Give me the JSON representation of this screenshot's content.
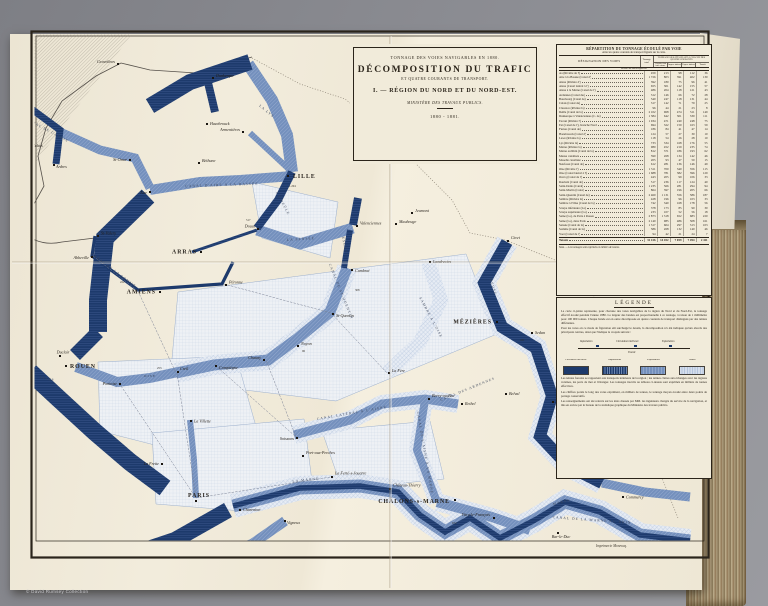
{
  "caption": "© David Rumsey Collection",
  "colors": {
    "band_dark": "#1d3a6c",
    "band_medium": "#7490bd",
    "band_light": "#dbe4ef",
    "sheet": "#f0ead9"
  },
  "plate": {
    "credit": "Imprimerie Monrocq.",
    "title_block": {
      "line1": "TONNAGE DES VOIES NAVIGABLES EN 1880.",
      "line2": "DÉCOMPOSITION DU TRAFIC",
      "line3": "ET QUATRE COURANTS DE TRANSPORT.",
      "line4": "I. — RÉGION DU NORD ET DU NORD-EST.",
      "line5": "MINISTÈRE DES TRAVAUX PUBLICS.",
      "line6": "1880 - 1881."
    },
    "table": {
      "title": "RÉPARTITION DU TONNAGE ÉCOULÉ PAR VOIE",
      "subtitle": "entre les quatre courants de transport figurés sur la carte.",
      "col_designation": "DÉSIGNATION DES VOIES",
      "col_total": "Tonnage total",
      "group_label": "TONNAGE SE RATTACHANT À CHACUN DES QUATRE COURANTS",
      "subcols": [
        "Circula- tion inté- rieure",
        "Impor- tations",
        "Expor- tations",
        "Transit"
      ],
      "units": "Milliers de tonnes effectives",
      "note": "Nota. — Les tonnages sont exprimés en milliers de tonnes.",
      "rows": [
        [
          "Aa (Rivière de l')",
          "459",
          "213",
          "98",
          "112",
          "36"
        ],
        [
          "Aire à la Bassée (Canal d')",
          "1 726",
          "803",
          "391",
          "402",
          "130"
        ],
        [
          "Aisne (Rivière d')",
          "392",
          "180",
          "75",
          "96",
          "41"
        ],
        [
          "Aisne (Canal latéral à l')",
          "655",
          "301",
          "142",
          "155",
          "57"
        ],
        [
          "Aisne à la Marne (Canal de l')",
          "486",
          "204",
          "118",
          "121",
          "43"
        ],
        [
          "Ardennes (Canal des)",
          "312",
          "146",
          "66",
          "72",
          "28"
        ],
        [
          "Bourbourg (Canal de)",
          "540",
          "247",
          "118",
          "131",
          "44"
        ],
        [
          "Calais (Canal de)",
          "317",
          "142",
          "71",
          "79",
          "25"
        ],
        [
          "Clarence (Rivière la)",
          "96",
          "44",
          "21",
          "23",
          "8"
        ],
        [
          "Deûle (Canal de la)",
          "2 102",
          "968",
          "474",
          "511",
          "149"
        ],
        [
          "Dunkerque à Valenciennes (C. de)",
          "1 384",
          "642",
          "301",
          "330",
          "111"
        ],
        [
          "Escaut (Rivière l')",
          "1 034",
          "471",
          "240",
          "248",
          "75"
        ],
        [
          "Est (Canal de l'), branche Nord",
          "694",
          "322",
          "150",
          "163",
          "59"
        ],
        [
          "Furnes (Canal de)",
          "186",
          "84",
          "41",
          "47",
          "14"
        ],
        [
          "Hazebrouck (Canal d')",
          "124",
          "57",
          "27",
          "30",
          "10"
        ],
        [
          "Lawe (Rivière la)",
          "118",
          "54",
          "26",
          "28",
          "10"
        ],
        [
          "Lys (Rivière la)",
          "733",
          "334",
          "168",
          "176",
          "55"
        ],
        [
          "Marne (Rivière la)",
          "980",
          "452",
          "219",
          "235",
          "74"
        ],
        [
          "Marne au Rhin (Canal de la)",
          "812",
          "371",
          "186",
          "193",
          "62"
        ],
        [
          "Meuse canalisée",
          "590",
          "268",
          "134",
          "142",
          "46"
        ],
        [
          "Moselle canalisée",
          "205",
          "93",
          "47",
          "50",
          "15"
        ],
        [
          "Neufossé (Canal de)",
          "612",
          "281",
          "136",
          "146",
          "49"
        ],
        [
          "Oise (Rivière l')",
          "1 511",
          "700",
          "340",
          "356",
          "115"
        ],
        [
          "Oise (Canal latéral à l')",
          "1 688",
          "781",
          "382",
          "396",
          "129"
        ],
        [
          "Ourcq (Canal de l')",
          "443",
          "205",
          "99",
          "106",
          "33"
        ],
        [
          "Roubaix (Canal de)",
          "517",
          "236",
          "117",
          "124",
          "40"
        ],
        [
          "Saint-Denis (Canal)",
          "1 235",
          "566",
          "281",
          "294",
          "94"
        ],
        [
          "Saint-Martin (Canal)",
          "864",
          "397",
          "196",
          "205",
          "66"
        ],
        [
          "Saint-Quentin (Canal de)",
          "2 460",
          "1 131",
          "556",
          "586",
          "187"
        ],
        [
          "Sambre (Rivière la)",
          "428",
          "196",
          "96",
          "103",
          "33"
        ],
        [
          "Sambre à l'Oise (Canal de la)",
          "742",
          "340",
          "168",
          "178",
          "56"
        ],
        [
          "Scarpe inférieure (La)",
          "378",
          "173",
          "85",
          "90",
          "30"
        ],
        [
          "Scarpe supérieure (La)",
          "233",
          "107",
          "52",
          "56",
          "18"
        ],
        [
          "Seine (La), de Paris à Rouen",
          "2 873",
          "1 318",
          "652",
          "683",
          "220"
        ],
        [
          "Seine (La), dans Paris",
          "2 140",
          "985",
          "486",
          "508",
          "161"
        ],
        [
          "Sensée (Canal de la)",
          "1 317",
          "604",
          "297",
          "313",
          "103"
        ],
        [
          "Somme (Canal de la)",
          "586",
          "268",
          "132",
          "140",
          "46"
        ],
        [
          "Yser (Canal de l')",
          "94",
          "42",
          "21",
          "24",
          "7"
        ],
        [
          "Totaux",
          "31 416",
          "14 452",
          "7 059",
          "7 494",
          "2 411"
        ]
      ]
    },
    "legend": {
      "title": "LÉGENDE",
      "paragraphs_top": [
        "La carte ci-jointe représente, pour chacune des voies navigables de la région du Nord et du Nord-Est, le tonnage effectif écoulé pendant l'année 1880. La largeur des bandes est proportionnelle à ce tonnage, à raison de 1 millimètre pour 100 000 tonnes. Chaque bande est en outre décomposée en quatre courants de transport distingués par des teintes différentes.",
        "Pour les voies où ce mode de figuration eût surchargé le dessin, la décomposition n'a été indiquée qu'aux abords des principaux centres, ainsi que l'indique le croquis suivant :"
      ],
      "diagram": {
        "left": "Importation",
        "middle": "Circulation intérieure",
        "right": "Exportation",
        "below": "Transit"
      },
      "swatches": [
        {
          "label": "Circulation intérieure"
        },
        {
          "label": "Importations"
        },
        {
          "label": "Exportations"
        },
        {
          "label": "Transit"
        }
      ],
      "paragraphs_bottom": [
        "Les teintes foncées se rapportent aux transports intérieurs de la région ; les teintes claires aux échanges avec les régions voisines, les ports de mer et l'étranger. Les tonnages inscrits au tableau ci-dessus sont exprimés en milliers de tonnes effectives.",
        "Les chiffres portés le long des voies expriment, en milliers de tonnes, le tonnage moyen écoulé entre deux points de partage consécutifs.",
        "Les renseignements ont été relevés sur les états dressés par MM. les ingénieurs chargés du service de la navigation, et mis en œuvre par le bureau de la statistique graphique du Ministère des travaux publics."
      ]
    },
    "map": {
      "cities": [
        {
          "name": "LILLE",
          "x": 288,
          "y": 176,
          "cls": "major",
          "dx": 5,
          "dy": 2
        },
        {
          "name": "ARRAS",
          "x": 201,
          "y": 252,
          "cls": "major",
          "dx": -4,
          "dy": 1.5,
          "anchor": "end"
        },
        {
          "name": "AMIENS",
          "x": 160,
          "y": 292,
          "cls": "major",
          "dx": -4,
          "dy": 1.5,
          "anchor": "end"
        },
        {
          "name": "ROUEN",
          "x": 66,
          "y": 366,
          "cls": "major",
          "dx": 4,
          "dy": 2
        },
        {
          "name": "PARIS",
          "x": 196,
          "y": 501,
          "cls": "major",
          "dx": 0,
          "dy": -4,
          "anchor": "middle"
        },
        {
          "name": "MÉZIÈRES",
          "x": 497,
          "y": 322,
          "cls": "major",
          "dx": -5,
          "dy": 1.5,
          "anchor": "end"
        },
        {
          "name": "CHÂLONS-s-MARNE",
          "x": 455,
          "y": 500,
          "cls": "major",
          "dx": -5,
          "dy": 3,
          "anchor": "end"
        },
        {
          "name": "Gravelines",
          "x": 118,
          "y": 64,
          "dx": -3,
          "dy": -1,
          "anchor": "end"
        },
        {
          "name": "Dunkerque",
          "x": 213,
          "y": 78,
          "dx": 3,
          "dy": -1
        },
        {
          "name": "Calais",
          "x": 30,
          "y": 149,
          "dx": 2,
          "dy": -2
        },
        {
          "name": "Ardres",
          "x": 54,
          "y": 165,
          "dx": 2,
          "dy": 3
        },
        {
          "name": "St-Omer",
          "x": 130,
          "y": 160,
          "dx": -3,
          "dy": 1,
          "anchor": "end"
        },
        {
          "name": "Aire",
          "x": 150,
          "y": 192,
          "dx": -3,
          "dy": 2,
          "anchor": "end"
        },
        {
          "name": "Béthune",
          "x": 199,
          "y": 163,
          "dx": 3,
          "dy": -1
        },
        {
          "name": "Hazebrouck",
          "x": 207,
          "y": 124,
          "dx": 3,
          "dy": 1
        },
        {
          "name": "Armentières",
          "x": 243,
          "y": 132,
          "dx": -3,
          "dy": -1,
          "anchor": "end"
        },
        {
          "name": "Douai",
          "x": 258,
          "y": 229,
          "dx": -3,
          "dy": -1.5,
          "anchor": "end"
        },
        {
          "name": "Valenciennes",
          "x": 357,
          "y": 226,
          "dx": 3,
          "dy": -1.5
        },
        {
          "name": "Maubeuge",
          "x": 396,
          "y": 224,
          "dx": 3,
          "dy": -1
        },
        {
          "name": "Jeumont",
          "x": 412,
          "y": 213,
          "dx": 3,
          "dy": -1
        },
        {
          "name": "Landrecies",
          "x": 430,
          "y": 262,
          "dx": 3,
          "dy": 1
        },
        {
          "name": "Cambrai",
          "x": 352,
          "y": 270,
          "dx": 3,
          "dy": 2
        },
        {
          "name": "St-Quentin",
          "x": 333,
          "y": 314,
          "dx": 3,
          "dy": 3
        },
        {
          "name": "Chauny",
          "x": 264,
          "y": 360,
          "dx": -3,
          "dy": -1,
          "anchor": "end"
        },
        {
          "name": "Noyon",
          "x": 298,
          "y": 346,
          "dx": 3,
          "dy": -1
        },
        {
          "name": "La Fère",
          "x": 389,
          "y": 373,
          "dx": 3,
          "dy": -1
        },
        {
          "name": "Compiègne",
          "x": 216,
          "y": 366,
          "dx": 3,
          "dy": 3
        },
        {
          "name": "Creil",
          "x": 178,
          "y": 372,
          "dx": 2,
          "dy": -2
        },
        {
          "name": "Pontoise",
          "x": 120,
          "y": 384,
          "dx": -3,
          "dy": 1,
          "anchor": "end"
        },
        {
          "name": "Duclair",
          "x": 60,
          "y": 356,
          "dx": 0,
          "dy": -2.5,
          "anchor": "middle"
        },
        {
          "name": "St-Valery",
          "x": 98,
          "y": 236,
          "dx": 3,
          "dy": -1.5
        },
        {
          "name": "Abbeville",
          "x": 92,
          "y": 257,
          "dx": -3,
          "dy": 2,
          "anchor": "end"
        },
        {
          "name": "Péronne",
          "x": 226,
          "y": 285,
          "dx": 3,
          "dy": -1.5
        },
        {
          "name": "Soissons",
          "x": 297,
          "y": 438,
          "dx": -3,
          "dy": 2,
          "anchor": "end"
        },
        {
          "name": "Berry-au-Bac",
          "x": 429,
          "y": 399,
          "dx": 3,
          "dy": -2
        },
        {
          "name": "Rethel",
          "x": 462,
          "y": 404,
          "dx": 3,
          "dy": 1
        },
        {
          "name": "Belval",
          "x": 506,
          "y": 394,
          "dx": 3,
          "dy": 1
        },
        {
          "name": "Vouziers",
          "x": 553,
          "y": 402,
          "dx": 3,
          "dy": 1
        },
        {
          "name": "Givet",
          "x": 508,
          "y": 241,
          "dx": 3,
          "dy": -2
        },
        {
          "name": "Sedan",
          "x": 532,
          "y": 333,
          "dx": 3,
          "dy": 1
        },
        {
          "name": "La Villette",
          "x": 191,
          "y": 421,
          "dx": 3,
          "dy": 0
        },
        {
          "name": "La Frette",
          "x": 162,
          "y": 464,
          "dx": -3,
          "dy": 1,
          "anchor": "end"
        },
        {
          "name": "Charenton",
          "x": 240,
          "y": 510,
          "dx": 3,
          "dy": 1
        },
        {
          "name": "Vigneux",
          "x": 285,
          "y": 521,
          "dx": 2,
          "dy": 3
        },
        {
          "name": "Port-aux-Perches",
          "x": 303,
          "y": 456,
          "dx": 3,
          "dy": -2
        },
        {
          "name": "La Ferté-s-Jouarre",
          "x": 332,
          "y": 477,
          "dx": 3,
          "dy": -2.5
        },
        {
          "name": "Château-Thierry",
          "x": 390,
          "y": 489,
          "dx": 3,
          "dy": -2.5
        },
        {
          "name": "Vitry-le-François",
          "x": 494,
          "y": 518,
          "dx": -4,
          "dy": -2,
          "anchor": "end"
        },
        {
          "name": "St-Mihiel",
          "x": 613,
          "y": 478,
          "dx": 3,
          "dy": -2
        },
        {
          "name": "Commercy",
          "x": 623,
          "y": 497,
          "dx": 3,
          "dy": 0
        },
        {
          "name": "Bar-le-Duc",
          "x": 558,
          "y": 533,
          "dx": 0,
          "dy": 5,
          "anchor": "middle"
        }
      ],
      "waterways": [
        {
          "text": "CANAL DE LA SOMME",
          "x": 113,
          "y": 271,
          "angle": 37
        },
        {
          "text": "OISE",
          "x": 150,
          "y": 377,
          "angle": 0
        },
        {
          "text": "SEINE",
          "x": 47,
          "y": 380,
          "angle": 12
        },
        {
          "text": "LA MARNE",
          "x": 306,
          "y": 481,
          "angle": -6
        },
        {
          "text": "MARNE",
          "x": 562,
          "y": 503,
          "angle": -14
        },
        {
          "text": "MEUSE",
          "x": 492,
          "y": 287,
          "angle": 72
        },
        {
          "text": "ESCAUT",
          "x": 344,
          "y": 247,
          "angle": 78
        },
        {
          "text": "CANAL DE ST-QUENTIN",
          "x": 340,
          "y": 292,
          "angle": 68
        },
        {
          "text": "CANAL LATÉRAL À L'AISNE",
          "x": 352,
          "y": 414,
          "angle": -10
        },
        {
          "text": "CANAL DES ARDENNES",
          "x": 468,
          "y": 390,
          "angle": -22
        },
        {
          "text": "SAMBRE À L'OISE",
          "x": 430,
          "y": 318,
          "angle": 62
        },
        {
          "text": "LA SENSÉE",
          "x": 301,
          "y": 240,
          "angle": -4
        },
        {
          "text": "CANAL D'AIRE À LA BASSÉE",
          "x": 222,
          "y": 186,
          "angle": -2
        },
        {
          "text": "LA DEÛLE",
          "x": 282,
          "y": 204,
          "angle": 62
        },
        {
          "text": "LA LYS",
          "x": 266,
          "y": 112,
          "angle": 40
        },
        {
          "text": "CANAL DE CALAIS",
          "x": 47,
          "y": 131,
          "angle": 28
        },
        {
          "text": "CANAL DE L'AISNE À LA MARNE",
          "x": 424,
          "y": 453,
          "angle": 80
        },
        {
          "text": "CANAL DE LA MARNE AU RHIN",
          "x": 592,
          "y": 521,
          "angle": 4
        }
      ],
      "figures": [
        {
          "text": "253",
          "x": 157,
          "y": 369
        },
        {
          "text": "517",
          "x": 246,
          "y": 221
        },
        {
          "text": "308",
          "x": 355,
          "y": 291
        },
        {
          "text": "1.204",
          "x": 289,
          "y": 187
        },
        {
          "text": "672",
          "x": 452,
          "y": 524
        },
        {
          "text": "431",
          "x": 520,
          "y": 341
        },
        {
          "text": "222",
          "x": 120,
          "y": 283
        },
        {
          "text": "96",
          "x": 302,
          "y": 352
        }
      ]
    }
  }
}
